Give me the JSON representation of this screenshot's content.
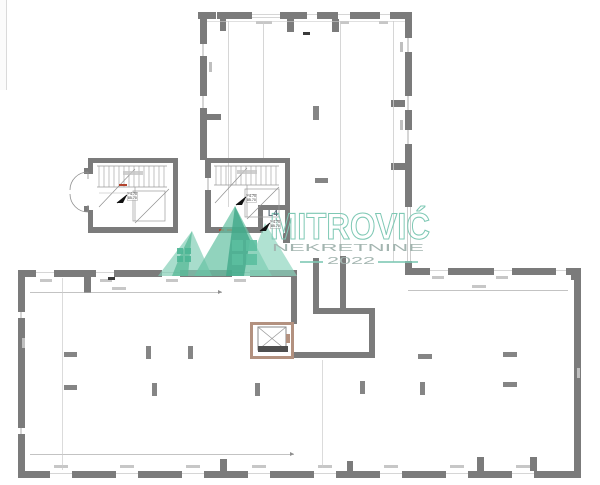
{
  "watermark": {
    "title": "MITROVIĆ",
    "subtitle": "NEKRETNINE",
    "year": "2022",
    "accent": "#7ec8b4",
    "text_color": "#a3b5b0"
  },
  "labels": {
    "level": "L4"
  },
  "markers": {
    "stair_left": {
      "line1": "+4.70",
      "line2": "85.70"
    },
    "stair_right": {
      "line1": "+4.70",
      "line2": "85.70"
    },
    "landing": {
      "line1": "+4.70",
      "line2": "85.70"
    }
  },
  "colors": {
    "wall": "#7b7b7b",
    "thin_line": "#cccccc",
    "elevator_frame": "#b3917f",
    "elevator_dark": "#4f4f4f",
    "stair_mark_red": "#b3442e",
    "logo_teal_dark": "#4db695",
    "logo_teal_light": "#8ad4bc"
  }
}
